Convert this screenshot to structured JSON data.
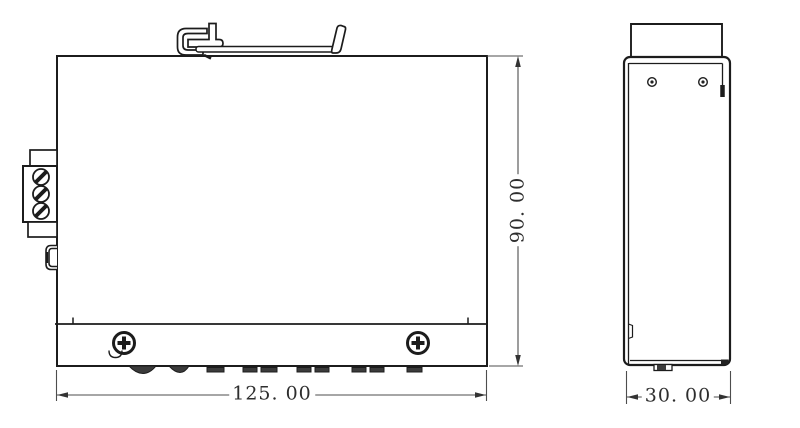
{
  "drawing": {
    "type": "technical-drawing",
    "views": [
      {
        "id": "front-view",
        "features": [
          "din-rail-clip",
          "terminal-block-3-screws",
          "side-button",
          "2-phillips-screws",
          "mounting-feet"
        ]
      },
      {
        "id": "side-view",
        "features": [
          "top-flange",
          "2-rivet-holes",
          "bottom-foot-tab"
        ]
      }
    ],
    "dimensions": {
      "width_label": "125. 00",
      "height_label": "90. 00",
      "depth_label": "30. 00"
    },
    "colors": {
      "background": "#ffffff",
      "outline": "#1c1c1c",
      "dimension_line": "#4d4d4d",
      "dark_fill": "#3b3b3b"
    }
  }
}
